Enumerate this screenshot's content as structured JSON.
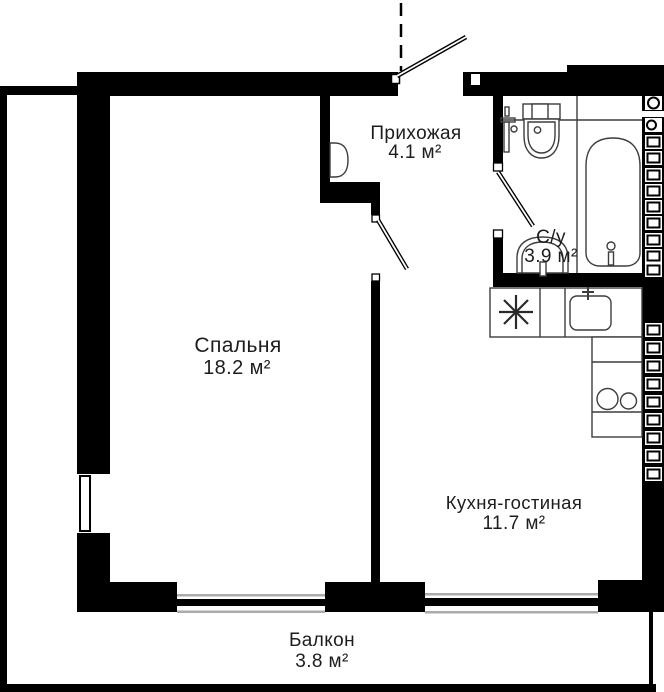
{
  "plan": {
    "rooms": [
      {
        "id": "hallway",
        "name": "Прихожая",
        "area": "4.1 м²"
      },
      {
        "id": "bathroom",
        "name": "С/у",
        "area": "3.9 м²"
      },
      {
        "id": "bedroom",
        "name": "Спальня",
        "area": "18.2 м²"
      },
      {
        "id": "kitchen_living",
        "name": "Кухня-гостиная",
        "area": "11.7 м²"
      },
      {
        "id": "balcony",
        "name": "Балкон",
        "area": "3.8 м²"
      }
    ],
    "colors": {
      "walls": "#000000",
      "fixtures": "#3d3d3d",
      "sill_lines": "#ababab",
      "text": "#1d1d1d",
      "background": "#ffffff"
    },
    "fixtures": [
      "entrance-door",
      "bedroom-door",
      "bathroom-door",
      "bathtub",
      "toilet",
      "washbasin",
      "towel-riser",
      "kitchen-sink",
      "hob-two-burners",
      "appliance-star",
      "vent-shaft-hatch",
      "bedroom-window",
      "balcony-glazing"
    ]
  }
}
